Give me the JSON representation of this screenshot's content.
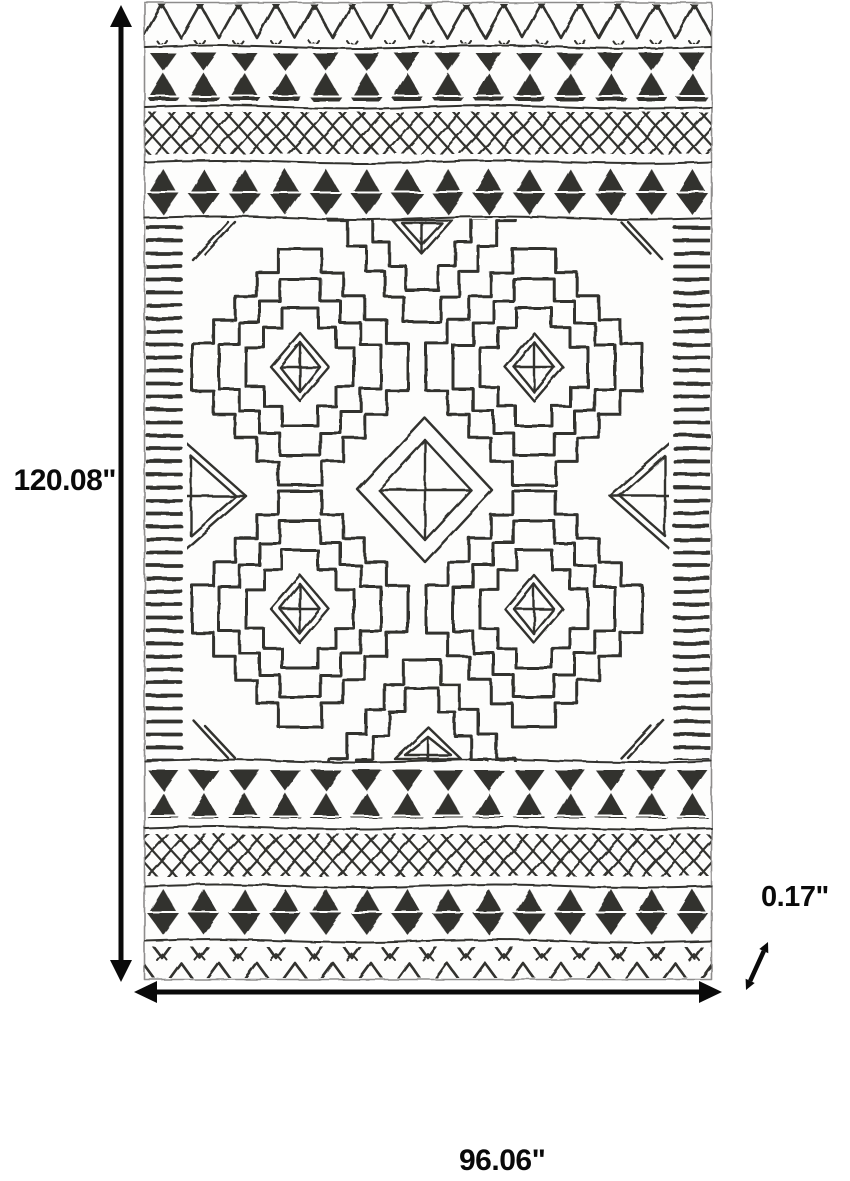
{
  "diagram": {
    "kind": "product-dimension-diagram",
    "subject": "black and white moroccan tribal pattern area rug, top view",
    "labels": {
      "height": "120.08\"",
      "width": "96.06\"",
      "depth": "0.17\""
    },
    "colors": {
      "background": "#ffffff",
      "rug_ink": "#31302e",
      "rug_paper": "#fdfdfc",
      "annotation": "#0a0a0a"
    }
  }
}
